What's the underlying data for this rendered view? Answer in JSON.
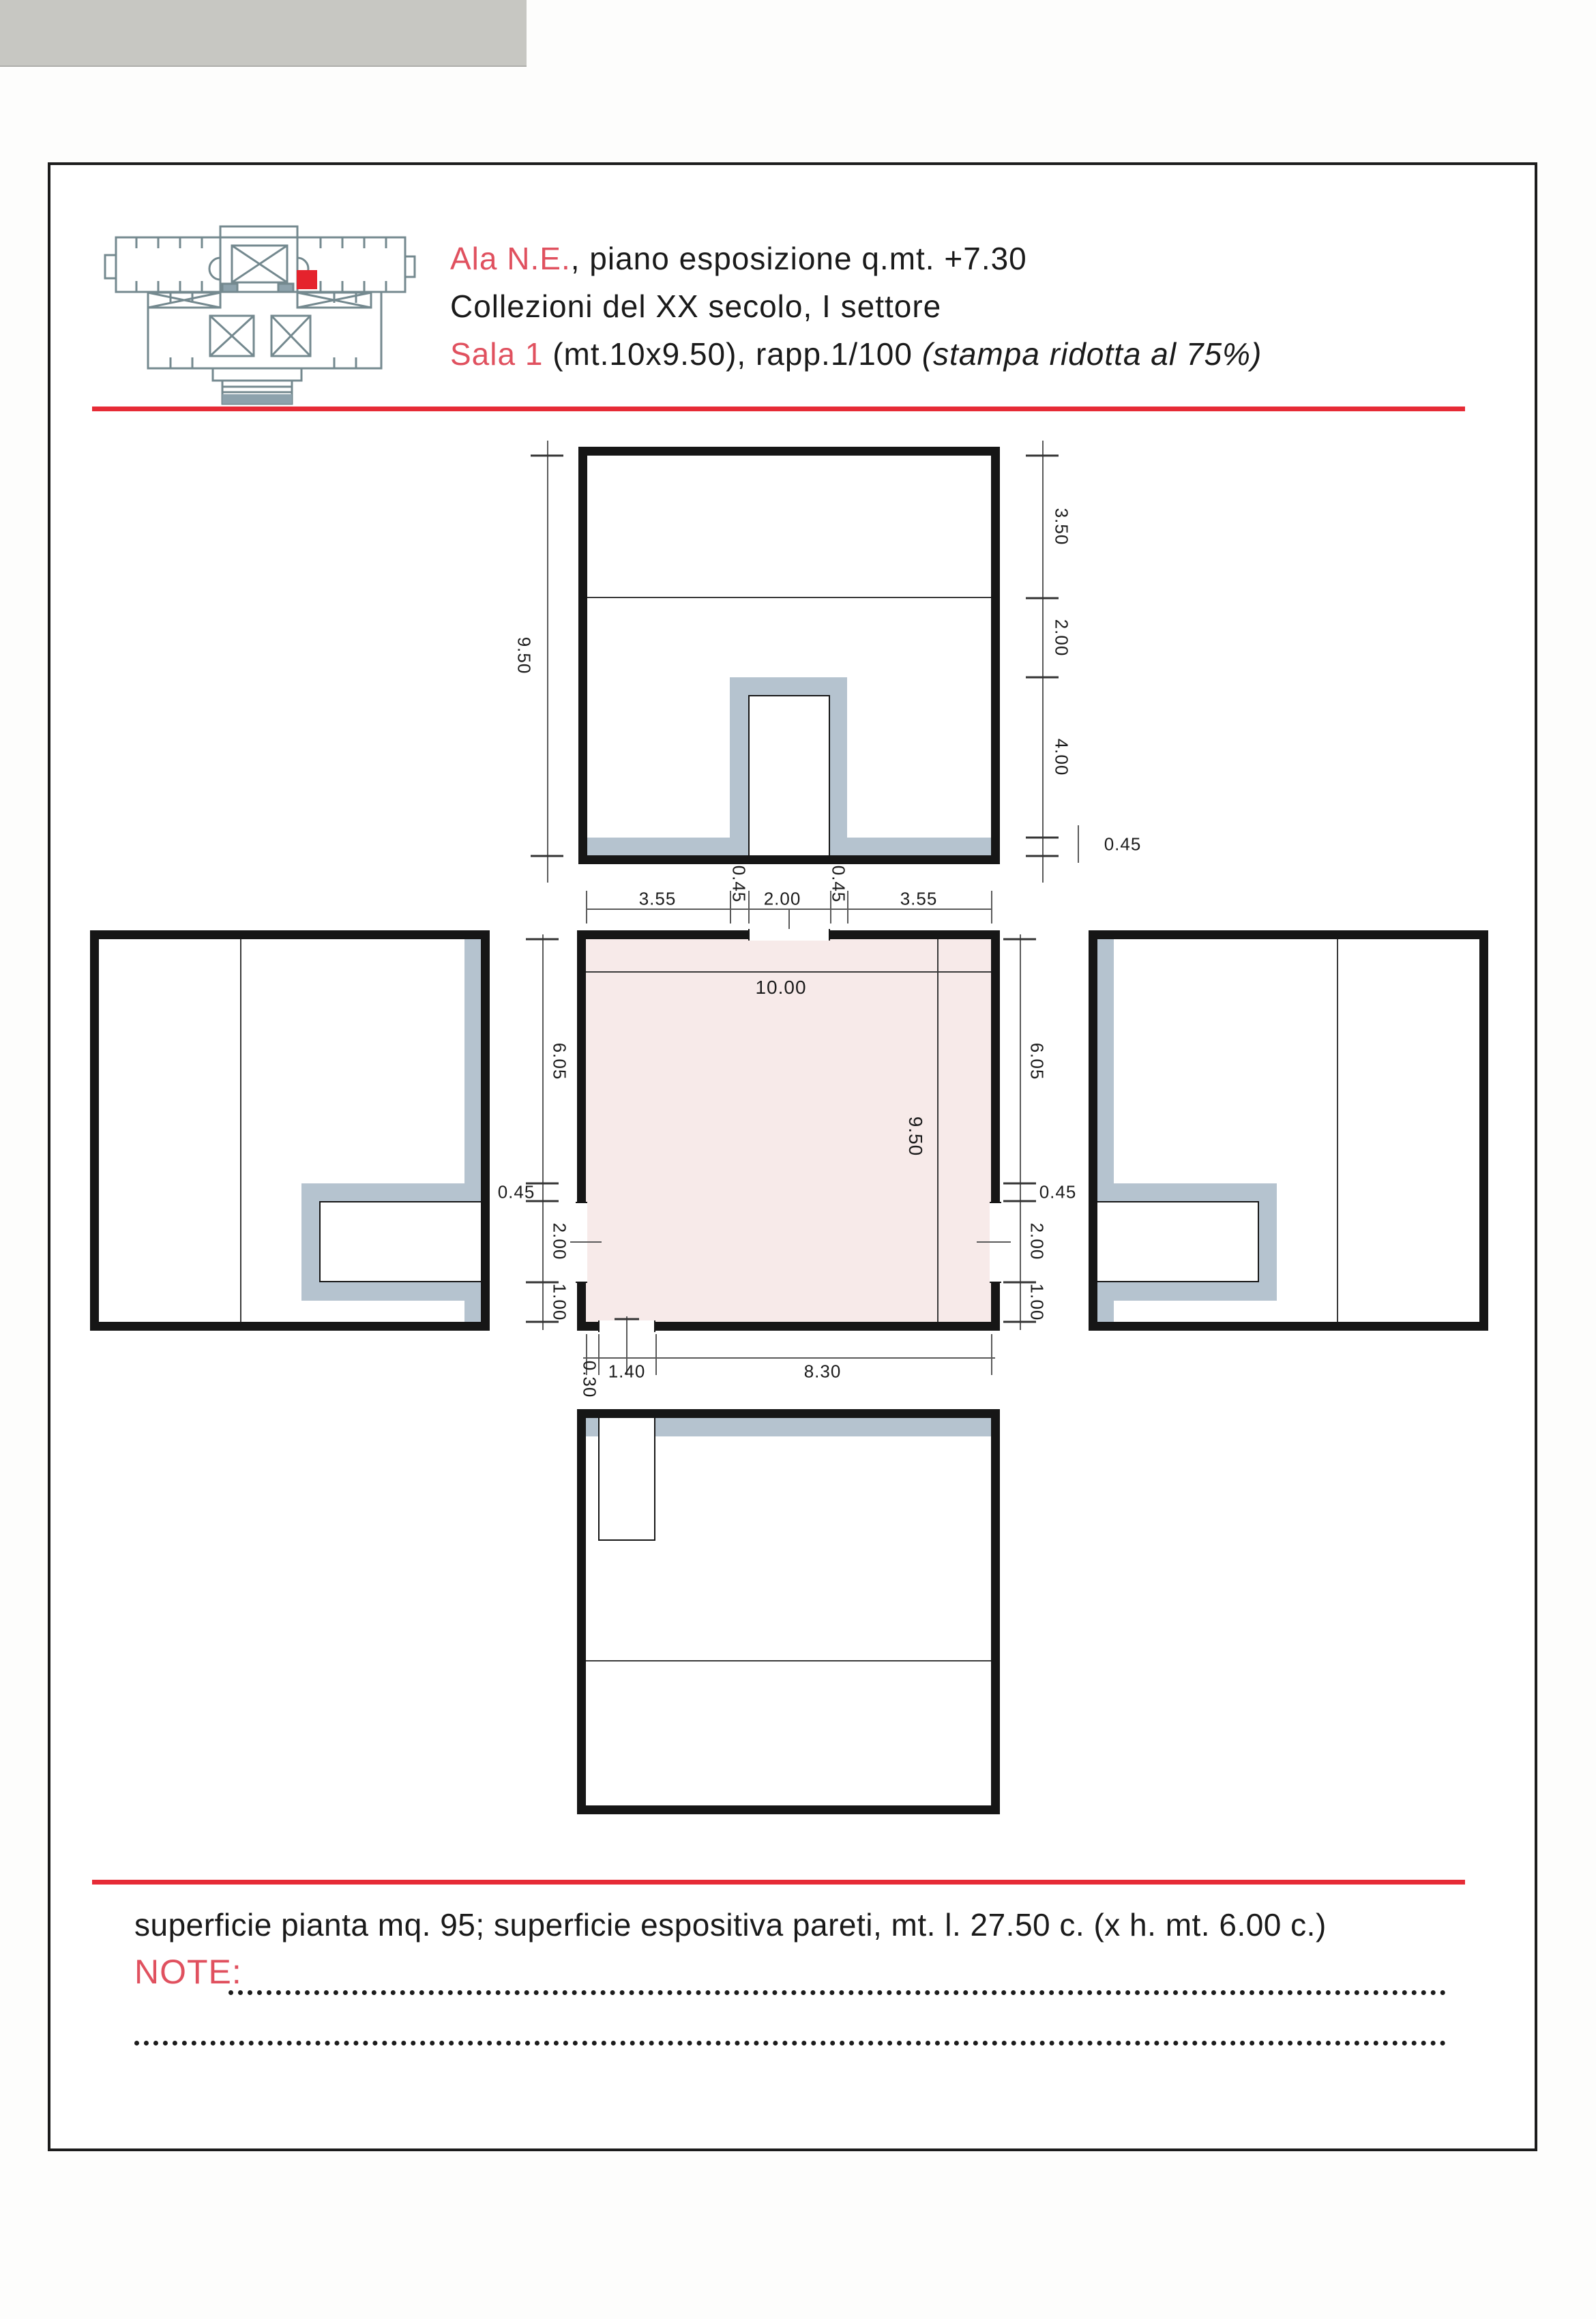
{
  "header": {
    "line1_accent": "Ala N.E.",
    "line1_rest": ", piano esposizione q.mt. +7.30",
    "line2": "Collezioni del XX secolo, I settore",
    "line3_accent": "Sala 1",
    "line3_mid": " (mt.10x9.50), rapp.1/100 ",
    "line3_italic": "(stampa ridotta al 75%)"
  },
  "colors": {
    "accent_red": "#e0515f",
    "rule_red": "#e62b36",
    "wall_gray": "#b5c3cf",
    "plan_pink": "#f7eae9",
    "marker_red": "#e5232d",
    "ink": "#1a1a1a",
    "logo_steel": "#74898f"
  },
  "dims": {
    "top_room": {
      "total_height": "9.50",
      "seg_top": "3.50",
      "seg_mid": "2.00",
      "seg_bottom": "4.00",
      "wall": "0.45",
      "jamb_left": "0.45",
      "jamb_right": "0.45"
    },
    "top_chain": {
      "left": "3.55",
      "door": "2.00",
      "right": "3.55"
    },
    "plan": {
      "width": "10.00",
      "depth": "9.50"
    },
    "left_chain": {
      "upper": "6.05",
      "wall": "0.45",
      "door": "2.00",
      "lower": "1.00"
    },
    "right_chain": {
      "upper": "6.05",
      "wall": "0.45",
      "door": "2.00",
      "lower": "1.00"
    },
    "bottom_chain": {
      "offset": "0.30",
      "door": "1.40",
      "rest": "8.30"
    }
  },
  "footer": {
    "summary": "superficie pianta mq. 95; superficie espositiva pareti, mt. l. 27.50 c. (x h. mt. 6.00 c.)",
    "note_label": "NOTE:"
  }
}
